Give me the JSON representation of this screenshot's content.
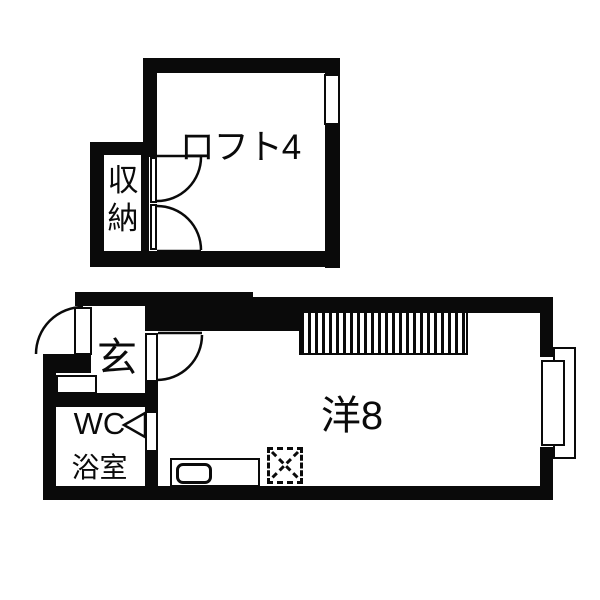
{
  "title": "apartment-floor-plan",
  "colors": {
    "wall": "#0a0a0a",
    "background": "#ffffff",
    "line": "#000000"
  },
  "upper_floor": {
    "loft": {
      "label": "ロフト4"
    },
    "storage": {
      "label": "収納",
      "chars": [
        "収",
        "納"
      ]
    }
  },
  "lower_floor": {
    "entrance": {
      "label": "玄"
    },
    "wc": {
      "label": "WC"
    },
    "bathroom": {
      "label": "浴室"
    },
    "main_room": {
      "label": "洋8"
    }
  }
}
